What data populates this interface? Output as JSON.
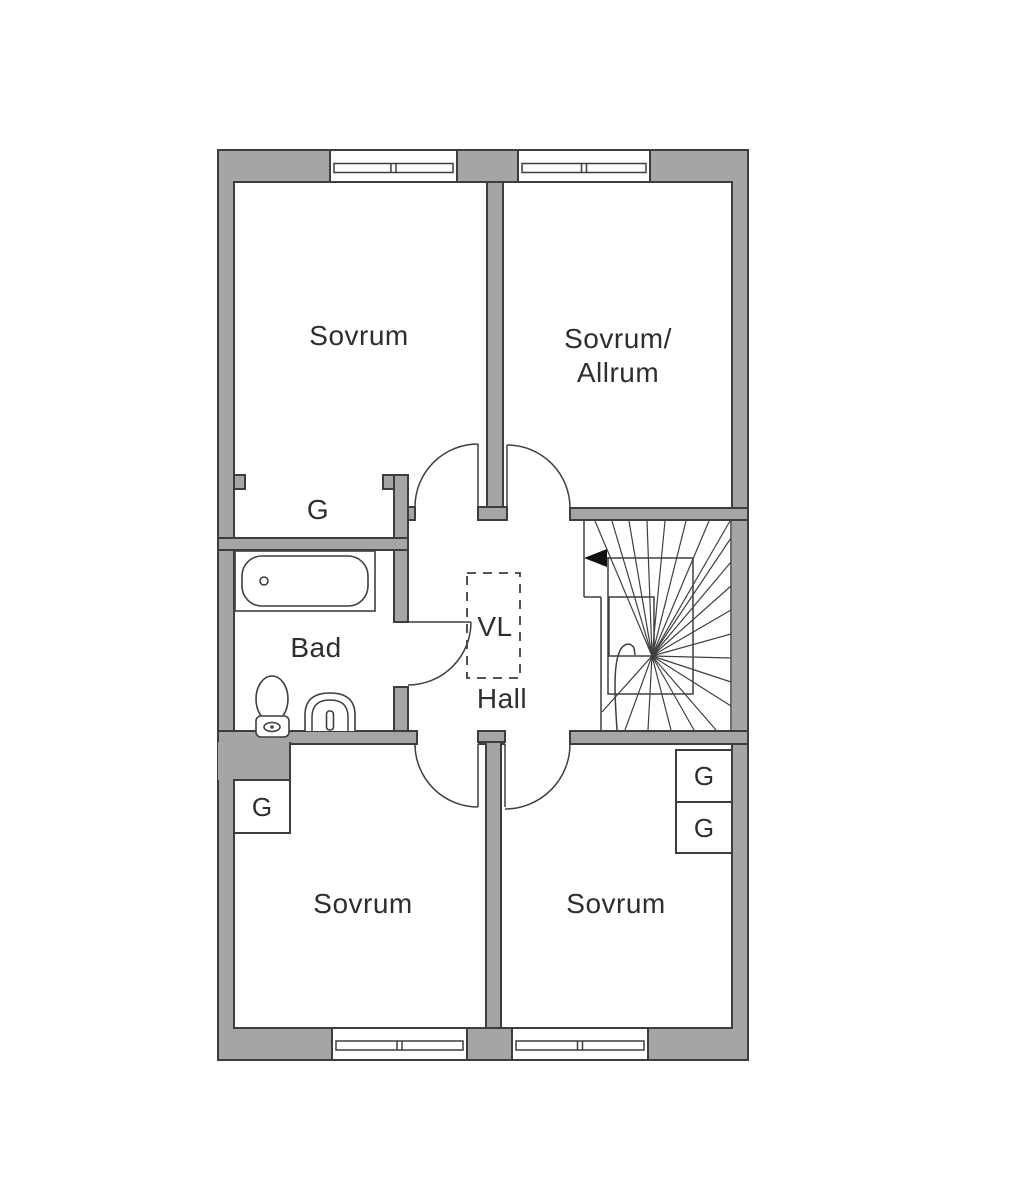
{
  "document": {
    "type": "floor-plan",
    "floor": "upper"
  },
  "rooms": {
    "top_left": {
      "label": "Sovrum"
    },
    "top_right": {
      "line1": "Sovrum/",
      "line2": "Allrum"
    },
    "bathroom": {
      "label": "Bad"
    },
    "hall": {
      "label": "Hall"
    },
    "shaft": {
      "label": "VL"
    },
    "bottom_left": {
      "label": "Sovrum"
    },
    "bottom_right": {
      "label": "Sovrum"
    }
  },
  "wardrobe": {
    "label": "G"
  },
  "icons": {
    "bathtub": "bathtub-icon",
    "toilet": "toilet-icon",
    "sink": "sink-icon",
    "staircase": "staircase-icon",
    "stair_direction": "stair-direction-arrow-icon",
    "door_swing": "door-swing-arc-icon",
    "window": "window-icon"
  },
  "colors": {
    "background": "#ffffff",
    "wall": "#a5a5a5",
    "outline": "#3d3d3d",
    "text": "#2e2e2e",
    "arrow": "#111111"
  }
}
